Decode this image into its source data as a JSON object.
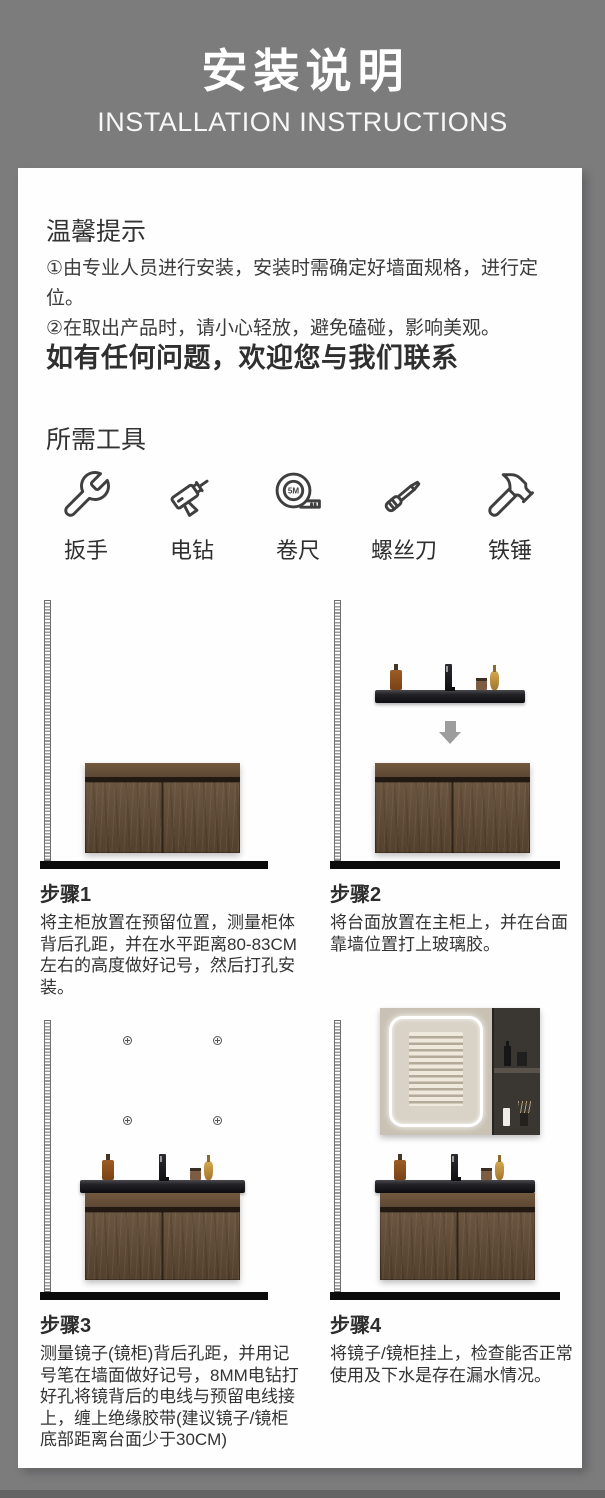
{
  "colors": {
    "page_background": "#7c7c7d",
    "card_background": "#fefefe",
    "wood_brown": "#5f4a36",
    "counter_black": "#141416"
  },
  "header": {
    "title": "安装说明",
    "subtitle": "INSTALLATION INSTRUCTIONS"
  },
  "tips": {
    "title": "温馨提示",
    "items": [
      "①由专业人员进行安装，安装时需确定好墙面规格，进行定位。",
      "②在取出产品时，请小心轻放，避免磕碰，影响美观。"
    ],
    "contact": "如有任何问题，欢迎您与我们联系"
  },
  "tools": {
    "title": "所需工具",
    "items": [
      {
        "icon": "wrench-icon",
        "label": "扳手"
      },
      {
        "icon": "drill-icon",
        "label": "电钻"
      },
      {
        "icon": "tape-measure-icon",
        "label": "卷尺",
        "badge": "5M"
      },
      {
        "icon": "screwdriver-icon",
        "label": "螺丝刀"
      },
      {
        "icon": "hammer-icon",
        "label": "铁锤"
      }
    ]
  },
  "steps": [
    {
      "label": "步骤1",
      "text": "将主柜放置在预留位置，测量柜体背后孔距，并在水平距离80-83CM左右的高度做好记号，然后打孔安装。"
    },
    {
      "label": "步骤2",
      "text": "将台面放置在主柜上，并在台面靠墙位置打上玻璃胶。"
    },
    {
      "label": "步骤3",
      "text": "测量镜子(镜柜)背后孔距，并用记号笔在墙面做好记号，8MM电钻打好孔将镜背后的电线与预留电线接上，缠上绝缘胶带(建议镜子/镜柜底部距离台面少于30CM)"
    },
    {
      "label": "步骤4",
      "text": "将镜子/镜柜挂上，检查能否正常使用及下水是存在漏水情况。"
    }
  ]
}
